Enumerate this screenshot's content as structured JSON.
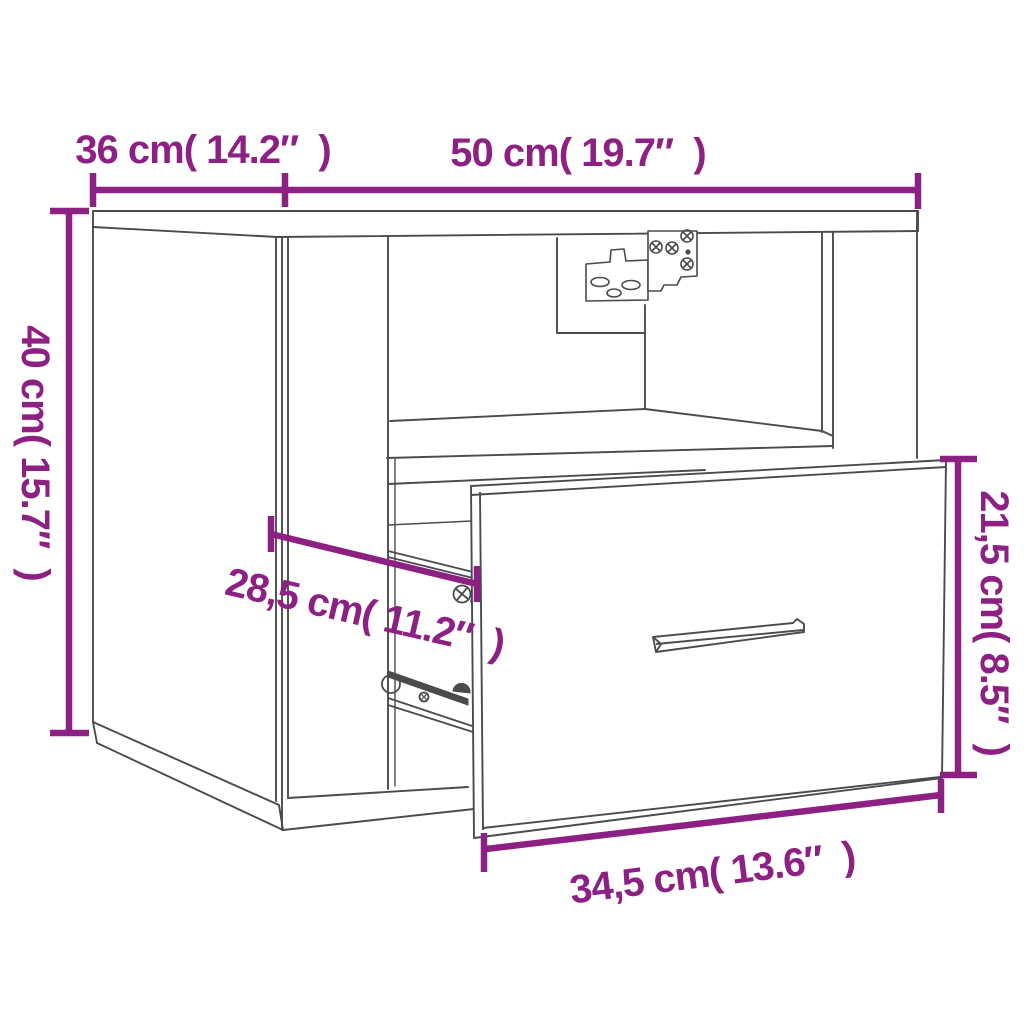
{
  "diagram": {
    "kind": "furniture-dimension-diagram",
    "subject": "wall-mounted bedside cabinet with open shelf and pulled-out drawer",
    "colors": {
      "accent": "#8D2083",
      "line_art": "#4B4B4B",
      "background": "#FFFFFF"
    },
    "dimensions": {
      "depth_top_left": {
        "label": "36 cm( 14.2″  )",
        "cm": 36,
        "inch": 14.2
      },
      "width_top": {
        "label": "50 cm( 19.7″  )",
        "cm": 50,
        "inch": 19.7
      },
      "height_left": {
        "label": "40 cm( 15.7″  )",
        "cm": 40,
        "inch": 15.7
      },
      "drawer_extension": {
        "label": "28,5 cm( 11.2″  )",
        "cm": 28.5,
        "inch": 11.2
      },
      "drawer_front_height": {
        "label": "21,5 cm( 8.5″  )",
        "cm": 21.5,
        "inch": 8.5
      },
      "drawer_front_width": {
        "label": "34,5 cm( 13.6″  )",
        "cm": 34.5,
        "inch": 13.6
      }
    }
  }
}
